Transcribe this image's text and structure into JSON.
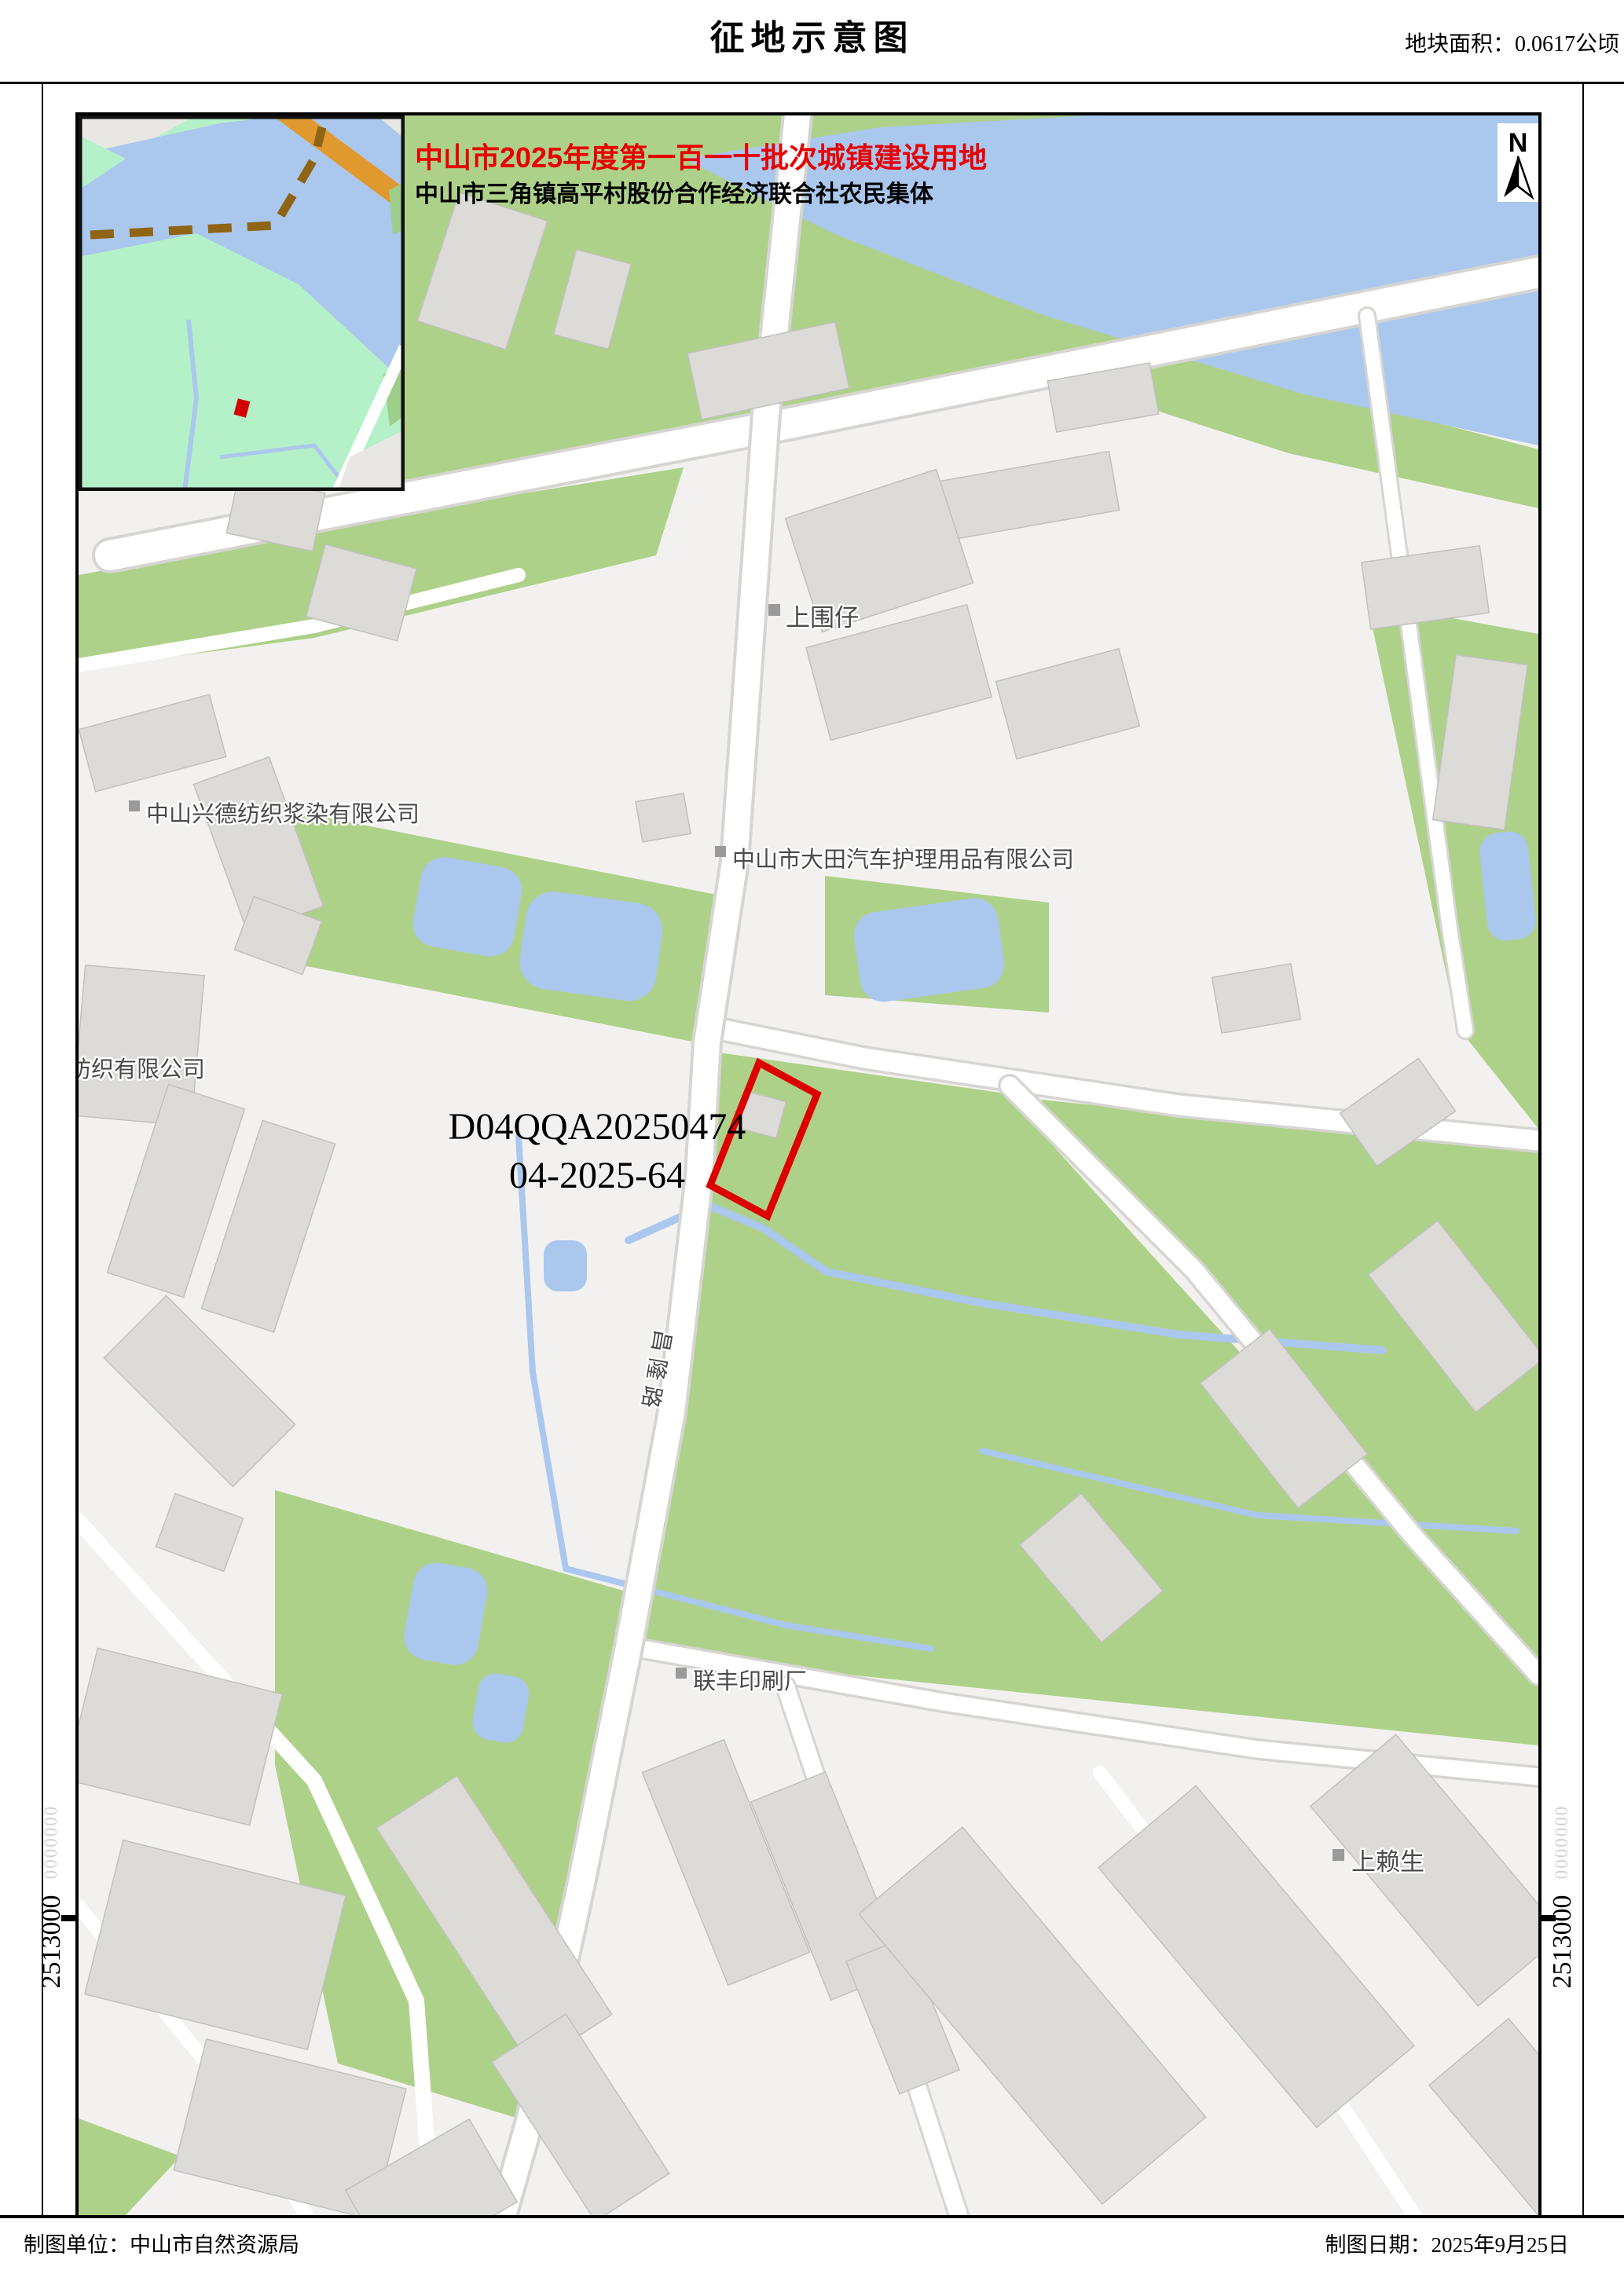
{
  "page": {
    "title": "征地示意图",
    "area_label": "地块面积：0.0617公顷",
    "footer_left": "制图单位：中山市自然资源局",
    "footer_right": "制图日期：2025年9月25日"
  },
  "map": {
    "batch_title": "中山市2025年度第一百一十批次城镇建设用地",
    "owner_subtitle": "中山市三角镇高平村股份合作经济联合社农民集体",
    "parcel": {
      "code": "D04QQA20250474",
      "number": "04-2025-64",
      "outline_color": "#dd0000"
    },
    "north_label": "N",
    "place_labels": {
      "shangweizai": "上围仔",
      "xingde_company": "中山兴德纺织浆染有限公司",
      "datian_company": "中山市大田汽车护理用品有限公司",
      "cheng_textile_partial": "成纺织有限公司",
      "lianfeng_printing": "联丰印刷厂",
      "shanglaisheng": "上赖生",
      "changlong_road": "昌隆路"
    },
    "coordinates": {
      "left": "2513000",
      "right": "2513000",
      "faint": "0000000"
    },
    "colors": {
      "green": "#aed189",
      "water": "#aac7ee",
      "building": "#dcdbd8",
      "road": "#ffffff",
      "headline_red": "#e60000",
      "parcel_red": "#dd0000",
      "inset_green": "#b4f0c8",
      "orange_road": "#e0992e",
      "boundary_brown": "#8f6414"
    }
  }
}
